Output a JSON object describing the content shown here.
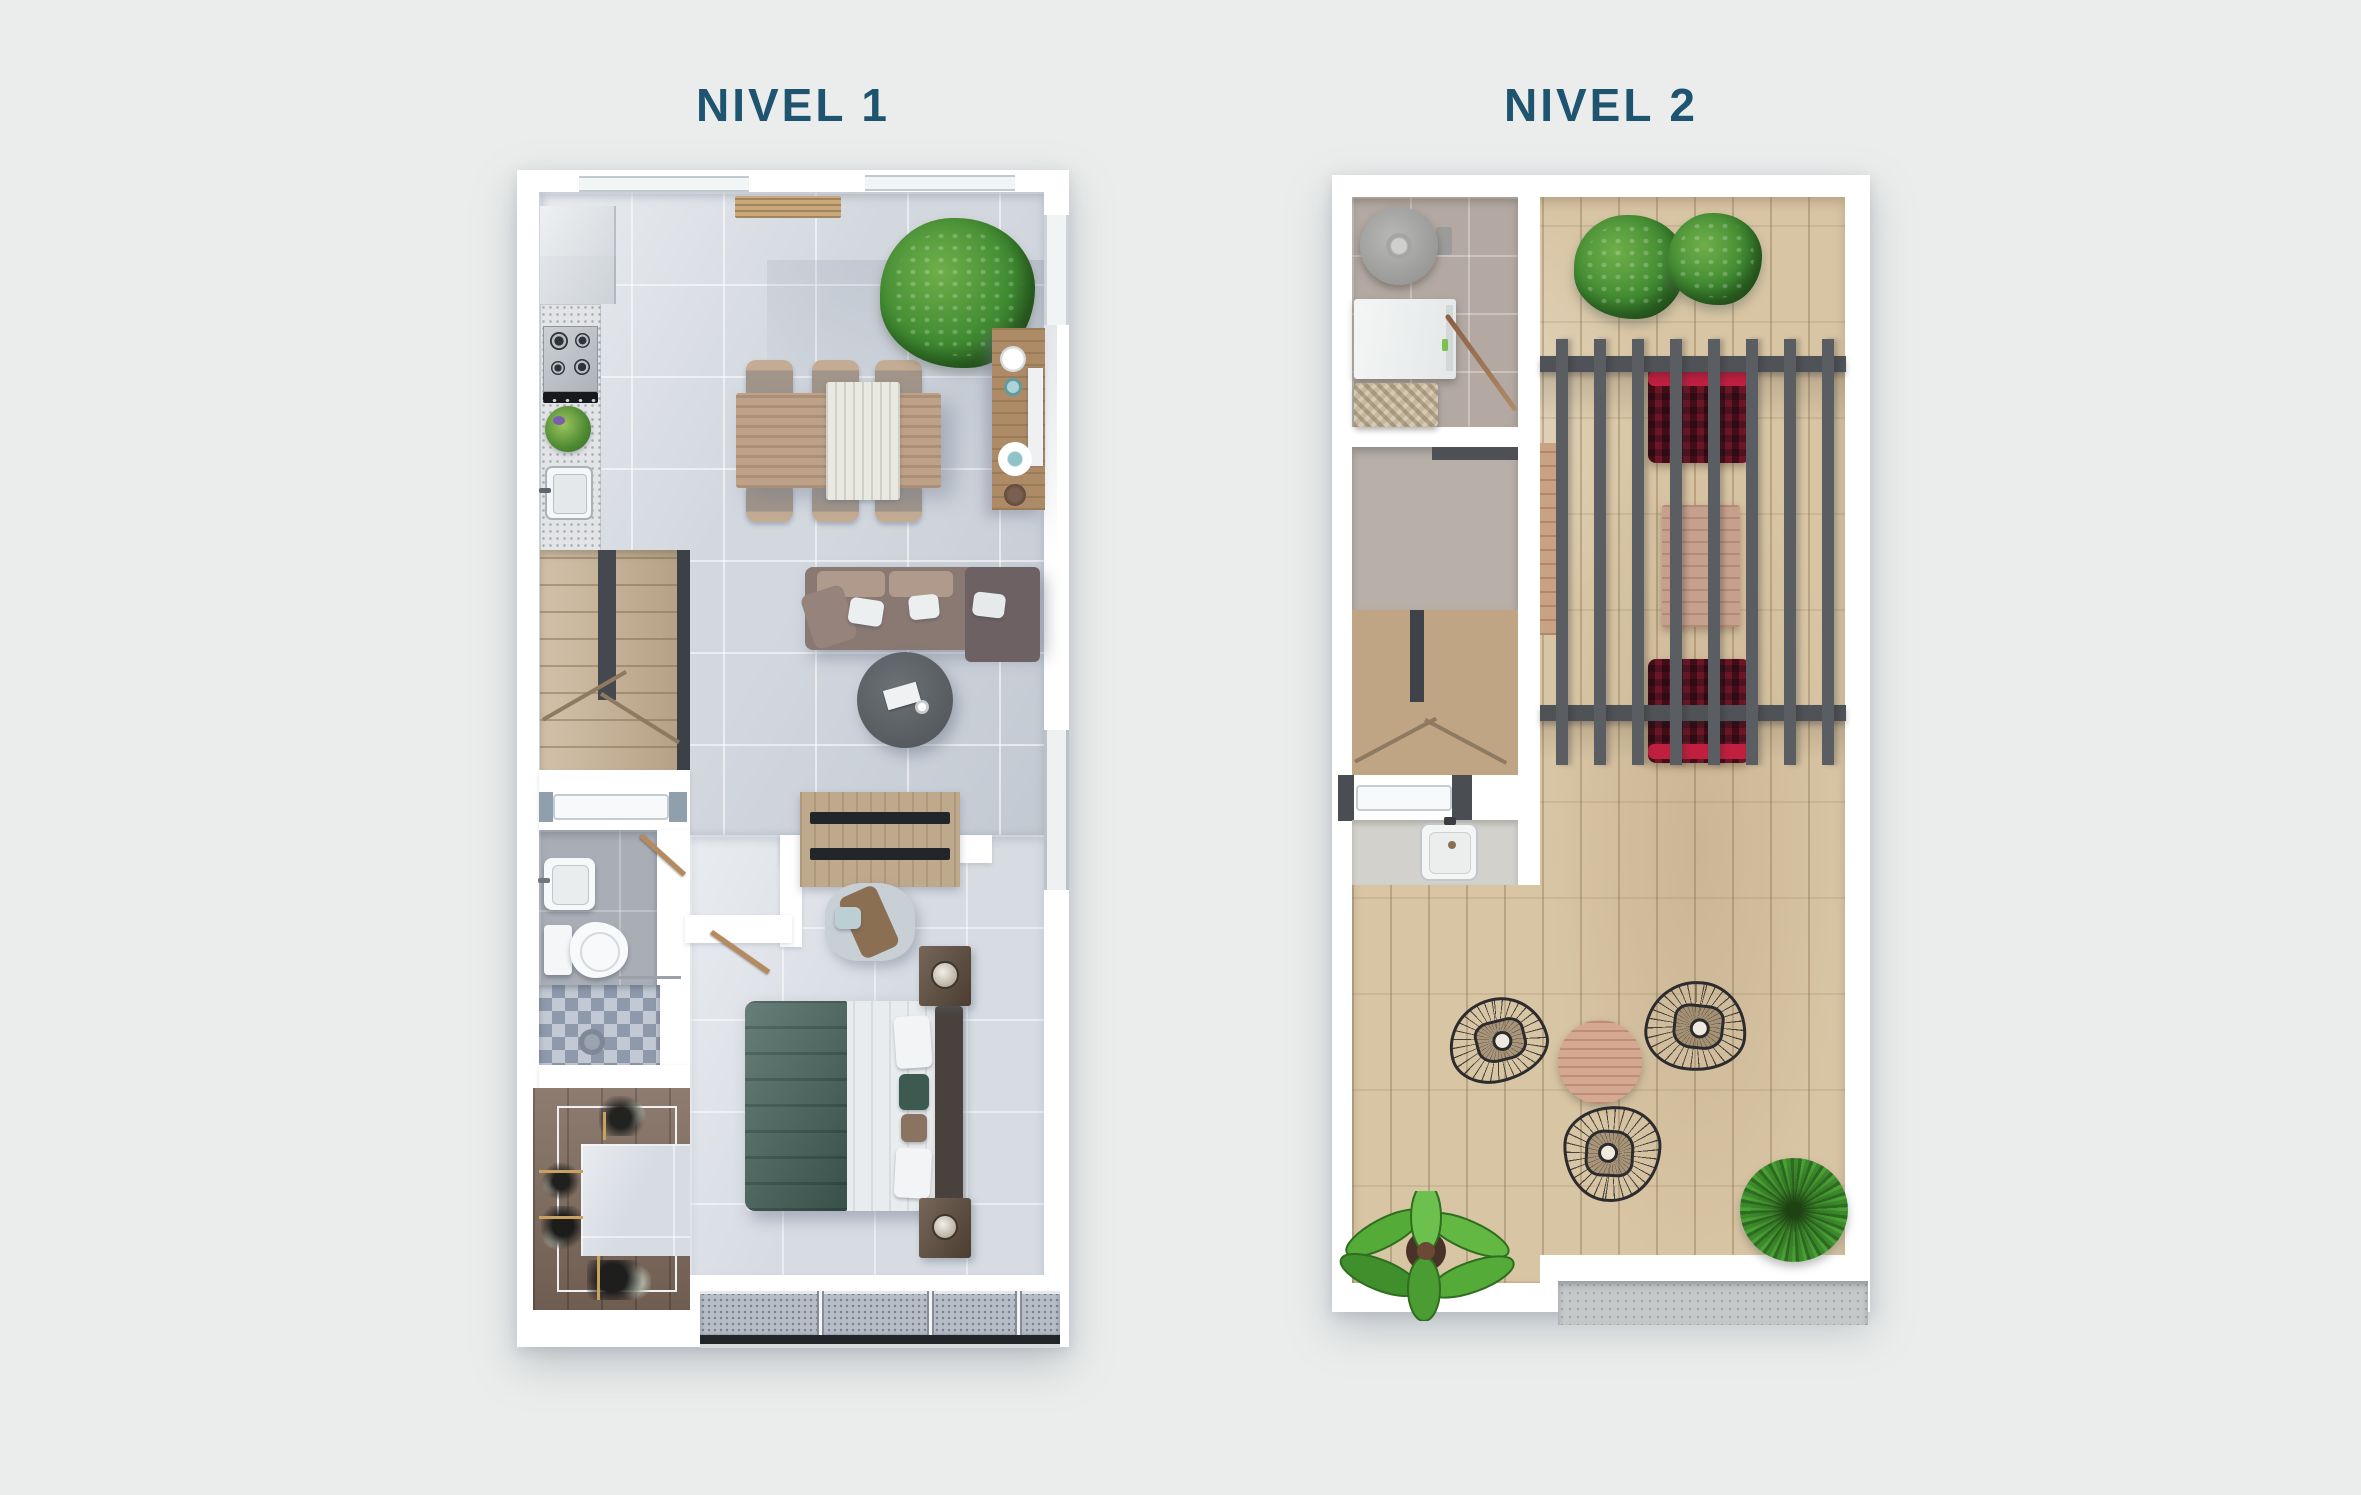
{
  "page": {
    "background_color": "#ebedec"
  },
  "titles": {
    "level1": "NIVEL 1",
    "level2": "NIVEL 2",
    "text_color": "#1e5470"
  },
  "palette": {
    "wall_white": "#ffffff",
    "tile_floor": "#d3d8df",
    "bathroom_floor": "#a9aeb6",
    "stair_wood": "#c3ac8d",
    "closet_wood": "#7e6a5c",
    "deck_wood": "#d8c5a4",
    "laundry_tile": "#b3a9a2",
    "pergola_slats": "#5a5d62",
    "lounger_red_bright": "#c01f3f",
    "lounger_red_dark": "#4f1220",
    "sofa_brown": "#8a7973",
    "bed_green": "#45625a",
    "dining_wood": "#bda189",
    "plant_green": "#3f8a31",
    "concrete_ledge": "#c5c8c8"
  }
}
